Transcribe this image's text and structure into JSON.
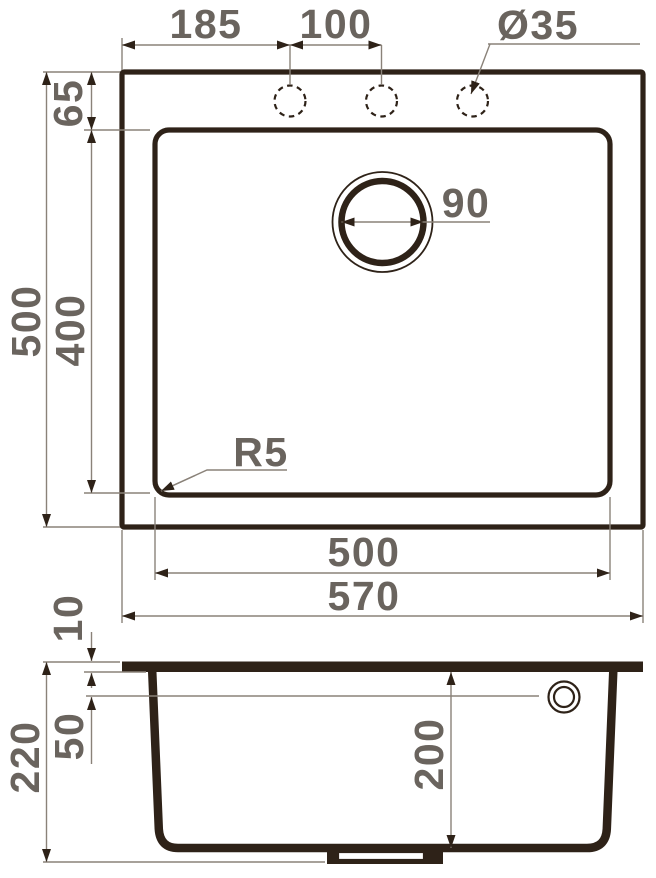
{
  "drawing": {
    "type": "sink-installation-dimension-drawing",
    "colors": {
      "outline": "#2e2218",
      "dimension_line": "#8a8279",
      "label_text": "#6a645e",
      "background": "#ffffff"
    },
    "top_view": {
      "dim_edge_to_first_hole": "185",
      "dim_hole_spacing": "100",
      "dim_faucet_hole_diameter": "Ø35",
      "dim_top_edge_to_bowl": "65",
      "dim_drain_diameter": "90",
      "dim_overall_depth": "500",
      "dim_bowl_depth": "400",
      "dim_corner_radius": "R5",
      "dim_bowl_width": "500",
      "dim_overall_width": "570"
    },
    "section_view": {
      "dim_rim_thickness": "10",
      "dim_overflow_offset": "50",
      "dim_overall_height": "220",
      "dim_bowl_height": "200"
    }
  }
}
